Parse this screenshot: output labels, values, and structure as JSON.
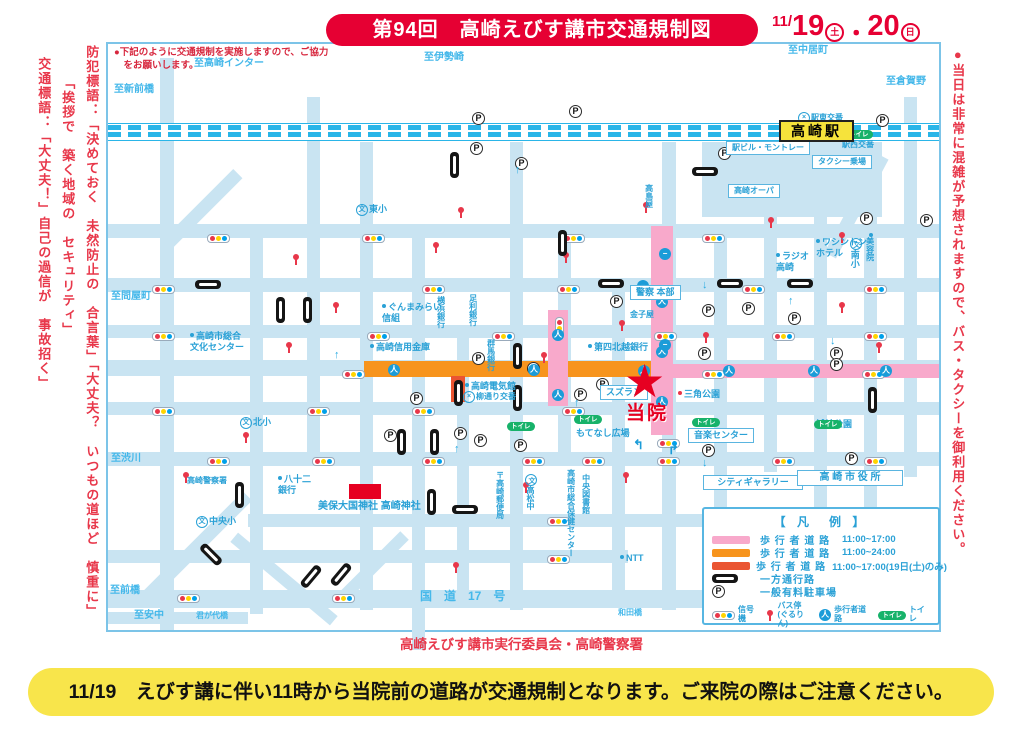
{
  "title": {
    "banner": "第94回　高崎えびす講市交通規制図",
    "date": {
      "prefix": "11/",
      "day1": "19",
      "mark1": "土",
      "sep": "・",
      "day2": "20",
      "mark2": "日"
    }
  },
  "notices": {
    "top_left_note": "●下記のように交通規制を実施しますので、ご協力\n　をお願いします。",
    "left_column1": "防犯標語：「決めておく　未然防止の　合言葉」「大丈夫？　いつもの道ほど　慎重に」",
    "left_column2": "「挨拶で　築く地域の　セキュリティ」",
    "left_column3": "交通標語：「大丈夫！」自己の過信が　事故招く」",
    "right_column": "●当日は非常に混雑が予想されますので、バス・タクシーを御利用ください。",
    "footer": "高崎えびす講市実行委員会・高崎警察署",
    "bottom_banner": "11/19　えびす講に伴い11時から当院前の道路が交通規制となります。ご来院の際はご注意ください。"
  },
  "legend": {
    "title": "【 凡　例 】",
    "rows": [
      {
        "sw": "pink",
        "label": "歩 行 者 道 路",
        "time": "11:00~17:00"
      },
      {
        "sw": "orange",
        "label": "歩 行 者 道 路",
        "time": "11:00~24:00"
      },
      {
        "sw": "verm",
        "label": "歩 行 者 道 路",
        "time": "11:00~17:00(19日(土)のみ)"
      },
      {
        "sw": "oneway",
        "label": "一方通行路",
        "time": ""
      },
      {
        "sw": "parking",
        "label": "一般有料駐車場",
        "time": ""
      }
    ],
    "bottom": [
      {
        "icon": "signal",
        "label": "信号機"
      },
      {
        "icon": "busstop",
        "label": "バス停\n(ぐるりん)"
      },
      {
        "icon": "walker",
        "label": "歩行者道路"
      },
      {
        "icon": "toilet",
        "label": "トイレ"
      }
    ]
  },
  "icons": {
    "walker_glyph": "人",
    "toilet_text": "トイレ",
    "parking_letter": "P",
    "school_glyph": "文",
    "koban_glyph": "×",
    "star": "★",
    "no_entry_glyph": "−"
  },
  "colors": {
    "accent_red": "#e60033",
    "map_road_blue": "#c9e4f2",
    "rail_cyan": "#2ab5e8",
    "label_blue": "#2aa1d6",
    "pink_road": "#f8a9cb",
    "orange_road": "#f7941d",
    "vermilion_road": "#ea5532",
    "banner_yellow": "#f8e54b",
    "station_yellow": "#f6e33b",
    "toilet_green": "#17b26a"
  },
  "map": {
    "clinic": {
      "label": "当院"
    },
    "labels": [
      {
        "t": "至高崎インター",
        "x": 86,
        "y": 14,
        "c": "dir"
      },
      {
        "t": "至新前橋",
        "x": 6,
        "y": 40,
        "c": "dir"
      },
      {
        "t": "至伊勢崎",
        "x": 316,
        "y": 8,
        "c": "dir"
      },
      {
        "t": "至中居町",
        "x": 680,
        "y": 1,
        "c": "dir"
      },
      {
        "t": "至倉賀野",
        "x": 778,
        "y": 32,
        "c": "dir"
      },
      {
        "t": "至問屋町",
        "x": 3,
        "y": 247,
        "c": "dir"
      },
      {
        "t": "至渋川",
        "x": 3,
        "y": 409,
        "c": "dir"
      },
      {
        "t": "至前橋",
        "x": 2,
        "y": 541,
        "c": "dir"
      },
      {
        "t": "至安中",
        "x": 26,
        "y": 566,
        "c": "dir"
      },
      {
        "t": "君が代橋",
        "x": 88,
        "y": 567,
        "c": "dir tiny"
      },
      {
        "t": "和田橋",
        "x": 510,
        "y": 564,
        "c": "dir tiny"
      },
      {
        "t": "国　道　17　号",
        "x": 312,
        "y": 545,
        "c": "dir",
        "fs": 12
      },
      {
        "t": "東小",
        "x": 248,
        "y": 160,
        "i": "school"
      },
      {
        "t": "北小",
        "x": 132,
        "y": 373,
        "i": "school"
      },
      {
        "t": "中央小",
        "x": 88,
        "y": 472,
        "i": "school"
      },
      {
        "t": "南小",
        "x": 741,
        "y": 194,
        "c": "v",
        "i": "school"
      },
      {
        "t": "高崎市総合\n文化センター",
        "x": 82,
        "y": 287,
        "d": "b"
      },
      {
        "t": "ぐんまみらい\n信組",
        "x": 274,
        "y": 258,
        "d": "b"
      },
      {
        "t": "横浜銀行",
        "x": 328,
        "y": 252,
        "c": "v",
        "fs": 8
      },
      {
        "t": "足利銀行",
        "x": 360,
        "y": 250,
        "c": "v",
        "fs": 8
      },
      {
        "t": "高崎信用金庫",
        "x": 262,
        "y": 298,
        "d": "b"
      },
      {
        "t": "群馬銀行",
        "x": 378,
        "y": 295,
        "c": "v",
        "fs": 8
      },
      {
        "t": "高崎電気館",
        "x": 357,
        "y": 337,
        "d": "b"
      },
      {
        "t": "柳通り交番",
        "x": 355,
        "y": 347,
        "c": "tiny",
        "i": "koban"
      },
      {
        "t": "第四北越銀行",
        "x": 480,
        "y": 298,
        "d": "b"
      },
      {
        "t": "警察\n本部",
        "x": 522,
        "y": 241,
        "c": "box",
        "fs": 9
      },
      {
        "t": "金子屋",
        "x": 522,
        "y": 266,
        "c": "tiny"
      },
      {
        "t": "スズラン",
        "x": 492,
        "y": 341,
        "c": "box"
      },
      {
        "t": "三角公園",
        "x": 570,
        "y": 345,
        "d": "r"
      },
      {
        "t": "もてなし広場",
        "x": 468,
        "y": 384
      },
      {
        "t": "音楽センター",
        "x": 580,
        "y": 384,
        "c": "box"
      },
      {
        "t": "城址公園",
        "x": 708,
        "y": 375
      },
      {
        "t": "シティギャラリー",
        "x": 595,
        "y": 431,
        "c": "box",
        "w": 88
      },
      {
        "t": "高 崎 市 役 所",
        "x": 689,
        "y": 426,
        "c": "box",
        "w": 94,
        "fs": 10
      },
      {
        "t": "駅ビル・モントレー",
        "x": 618,
        "y": 97,
        "c": "box tiny"
      },
      {
        "t": "駅西交番",
        "x": 734,
        "y": 96,
        "c": "tiny"
      },
      {
        "t": "タクシー乗場",
        "x": 704,
        "y": 111,
        "c": "box tiny"
      },
      {
        "t": "駅東交番",
        "x": 690,
        "y": 68,
        "c": "tiny",
        "i": "koban"
      },
      {
        "t": "高崎オーパ",
        "x": 620,
        "y": 140,
        "c": "box tiny"
      },
      {
        "t": "ラジオ\n高崎",
        "x": 668,
        "y": 207,
        "d": "b"
      },
      {
        "t": "ワシントン\nホテル",
        "x": 708,
        "y": 193,
        "d": "b"
      },
      {
        "t": "美容院",
        "x": 757,
        "y": 189,
        "c": "v",
        "fs": 8,
        "d": "b"
      },
      {
        "t": "美保大国神社 高崎神社",
        "x": 210,
        "y": 457,
        "fs": 10
      },
      {
        "t": "八十二\n銀行",
        "x": 170,
        "y": 430,
        "d": "b"
      },
      {
        "t": "高崎警察署",
        "x": 79,
        "y": 432,
        "c": "tiny"
      },
      {
        "t": "〒高崎郵便局",
        "x": 387,
        "y": 427,
        "c": "v",
        "fs": 8
      },
      {
        "t": "高松中",
        "x": 417,
        "y": 430,
        "c": "v",
        "fs": 8,
        "i": "school"
      },
      {
        "t": "高崎市総合保健センター",
        "x": 458,
        "y": 425,
        "c": "v",
        "fs": 8
      },
      {
        "t": "中央図書館",
        "x": 473,
        "y": 430,
        "c": "v",
        "fs": 8
      },
      {
        "t": "NTT",
        "x": 512,
        "y": 509,
        "d": "b"
      },
      {
        "t": "高島屋",
        "x": 536,
        "y": 140,
        "c": "v",
        "fs": 8
      },
      {
        "t": "高崎駅",
        "x": 671,
        "y": 76,
        "c": "station"
      }
    ],
    "parkings": [
      [
        364,
        68
      ],
      [
        461,
        61
      ],
      [
        362,
        98
      ],
      [
        407,
        113
      ],
      [
        610,
        103
      ],
      [
        768,
        70
      ],
      [
        752,
        168
      ],
      [
        812,
        170
      ],
      [
        364,
        308
      ],
      [
        302,
        348
      ],
      [
        276,
        385
      ],
      [
        346,
        383
      ],
      [
        366,
        390
      ],
      [
        406,
        395
      ],
      [
        502,
        251
      ],
      [
        594,
        260
      ],
      [
        634,
        258
      ],
      [
        680,
        268
      ],
      [
        590,
        303
      ],
      [
        488,
        334
      ],
      [
        466,
        344
      ],
      [
        594,
        400
      ],
      [
        737,
        408
      ],
      [
        722,
        303
      ],
      [
        722,
        314
      ],
      [
        419,
        318
      ]
    ],
    "signals": [
      [
        99,
        190
      ],
      [
        254,
        190
      ],
      [
        454,
        190
      ],
      [
        594,
        190
      ],
      [
        44,
        241
      ],
      [
        314,
        241
      ],
      [
        449,
        241
      ],
      [
        546,
        241
      ],
      [
        634,
        241
      ],
      [
        756,
        241
      ],
      [
        44,
        288
      ],
      [
        259,
        288
      ],
      [
        384,
        288
      ],
      [
        546,
        288
      ],
      [
        664,
        288
      ],
      [
        756,
        288
      ],
      [
        234,
        326
      ],
      [
        594,
        326
      ],
      [
        754,
        326
      ],
      [
        44,
        363
      ],
      [
        199,
        363
      ],
      [
        304,
        363
      ],
      [
        454,
        363
      ],
      [
        549,
        395
      ],
      [
        99,
        413
      ],
      [
        204,
        413
      ],
      [
        314,
        413
      ],
      [
        414,
        413
      ],
      [
        474,
        413
      ],
      [
        549,
        413
      ],
      [
        664,
        413
      ],
      [
        756,
        413
      ],
      [
        439,
        473
      ],
      [
        439,
        511
      ],
      [
        69,
        550
      ],
      [
        224,
        550
      ],
      [
        594,
        550
      ],
      [
        739,
        550
      ],
      [
        447,
        273,
        "v"
      ]
    ],
    "busstops": [
      [
        184,
        210
      ],
      [
        324,
        198
      ],
      [
        454,
        208
      ],
      [
        224,
        258
      ],
      [
        177,
        298
      ],
      [
        510,
        276
      ],
      [
        730,
        258
      ],
      [
        134,
        388
      ],
      [
        414,
        438
      ],
      [
        514,
        428
      ],
      [
        594,
        518
      ],
      [
        344,
        518
      ],
      [
        74,
        428
      ],
      [
        730,
        188
      ],
      [
        534,
        158
      ],
      [
        349,
        163
      ],
      [
        659,
        173
      ],
      [
        432,
        308
      ],
      [
        767,
        298
      ],
      [
        594,
        288
      ]
    ],
    "oneways": [
      [
        87,
        236,
        "h"
      ],
      [
        490,
        235,
        "h"
      ],
      [
        609,
        235,
        "h"
      ],
      [
        679,
        235,
        "h"
      ],
      [
        344,
        461,
        "h"
      ],
      [
        584,
        123,
        "h"
      ],
      [
        168,
        253,
        "v"
      ],
      [
        195,
        253,
        "v"
      ],
      [
        342,
        108,
        "v"
      ],
      [
        450,
        186,
        "v"
      ],
      [
        405,
        299,
        "v"
      ],
      [
        405,
        341,
        "v"
      ],
      [
        346,
        336,
        "v"
      ],
      [
        289,
        385,
        "v"
      ],
      [
        322,
        385,
        "v"
      ],
      [
        760,
        343,
        "v"
      ],
      [
        127,
        438,
        "v"
      ],
      [
        319,
        445,
        "v"
      ],
      [
        90,
        506,
        "d45"
      ],
      [
        190,
        528,
        "dm45"
      ],
      [
        220,
        526,
        "dm45"
      ]
    ],
    "toilets": [
      [
        737,
        86
      ],
      [
        399,
        378
      ],
      [
        466,
        371
      ],
      [
        584,
        374
      ],
      [
        706,
        376
      ]
    ],
    "walkers": [
      [
        280,
        320
      ],
      [
        420,
        320
      ],
      [
        530,
        321
      ],
      [
        548,
        252
      ],
      [
        548,
        302
      ],
      [
        548,
        352
      ],
      [
        444,
        285
      ],
      [
        444,
        345
      ],
      [
        615,
        321
      ],
      [
        700,
        321
      ],
      [
        772,
        321
      ]
    ],
    "noentries": [
      [
        551,
        204
      ],
      [
        529,
        236
      ],
      [
        551,
        295
      ]
    ],
    "arrows": [
      [
        407,
        121,
        "↑"
      ],
      [
        346,
        400,
        "↑"
      ],
      [
        466,
        354,
        "↑"
      ],
      [
        594,
        414,
        "↓"
      ],
      [
        680,
        252,
        "↑"
      ],
      [
        722,
        292,
        "↓"
      ],
      [
        594,
        236,
        "↓"
      ],
      [
        226,
        306,
        "↑"
      ]
    ],
    "curves": [
      [
        525,
        394,
        "↰"
      ],
      [
        560,
        399,
        "↱"
      ]
    ]
  }
}
